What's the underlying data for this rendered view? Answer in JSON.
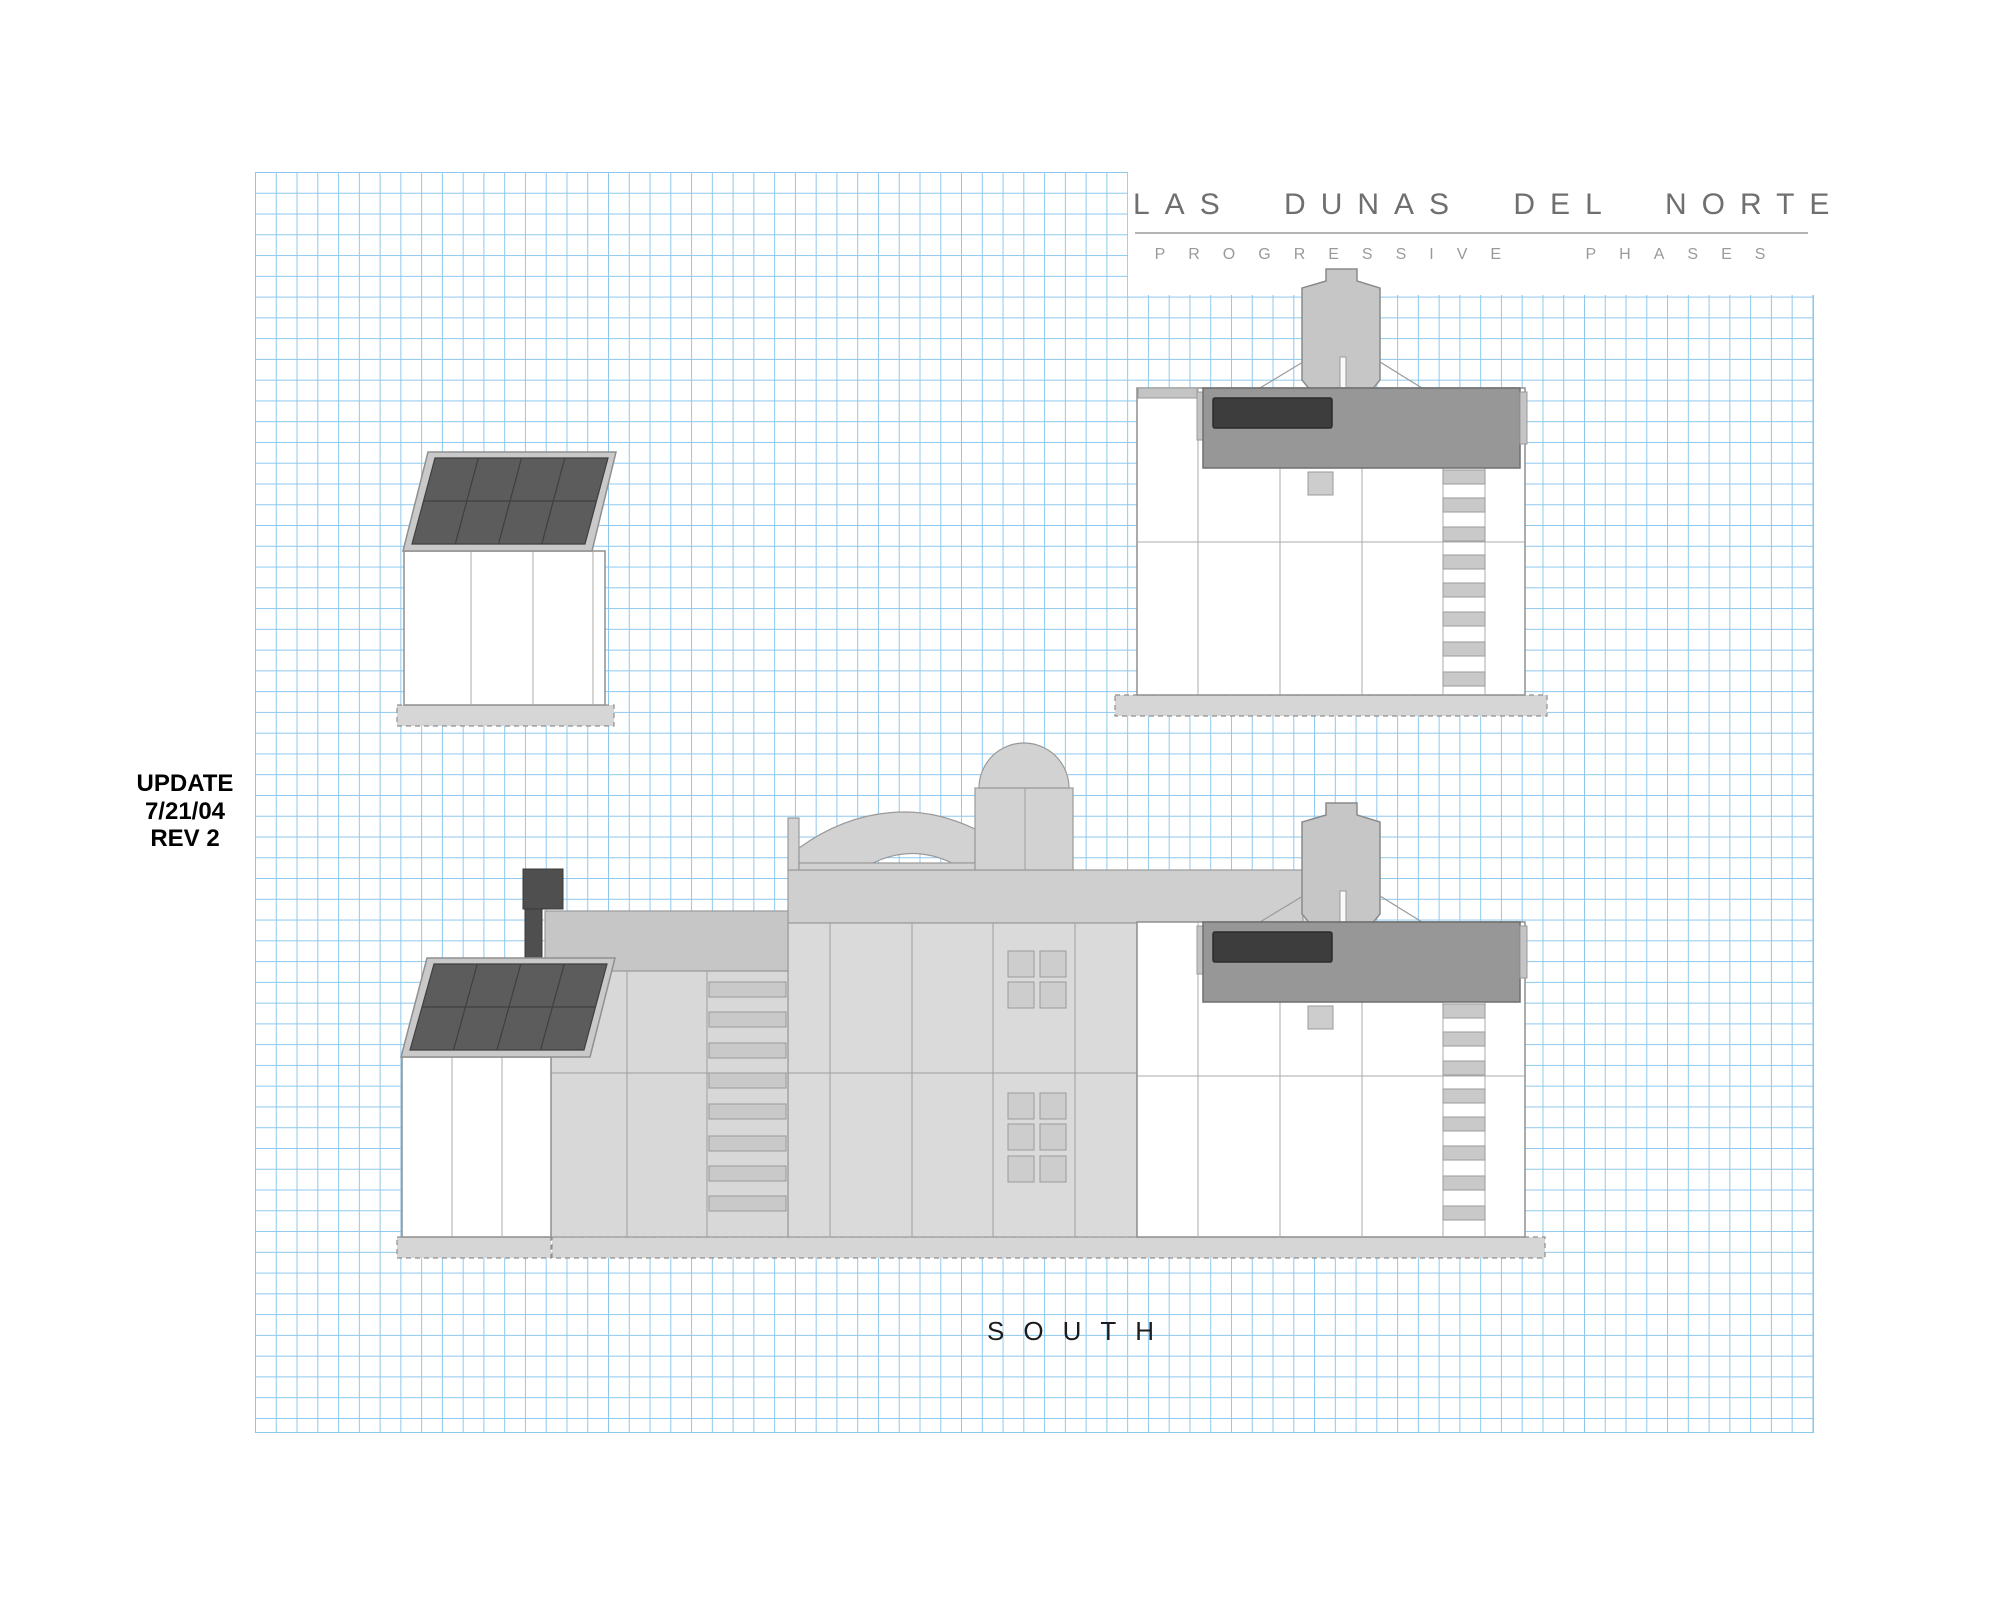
{
  "title_block": {
    "project_title": "LAS DUNAS DEL NORTE",
    "subtitle": "PROGRESSIVE PHASES"
  },
  "revision_note": {
    "line1": "UPDATE",
    "line2": "7/21/04",
    "line3": "REV 2"
  },
  "elevation_label": "SOUTH",
  "colors": {
    "grid_line": "#8dc8ee",
    "paper": "#ffffff",
    "title_text": "#6f6f6f",
    "subtitle_text": "#9a9a9a",
    "divider": "#b4b4b4",
    "note_text": "#000000",
    "label_text": "#1c1c1c",
    "wall_white": "#ffffff",
    "solar_panel": "#5c5c5c",
    "solar_frame": "#c9c9c9",
    "roof_band": "#c6c6c6",
    "block_band": "#cfcfcf",
    "facade_light": "#d8d8d8",
    "facade_block": "#dadada",
    "parapet_gray": "#979797",
    "window_dark": "#3d3d3d",
    "chimney_dark": "#4f4f4f",
    "detail_gray": "#c9c9c9",
    "arch_gray": "#d2d2d2",
    "foundation": "#d6d6d6"
  }
}
